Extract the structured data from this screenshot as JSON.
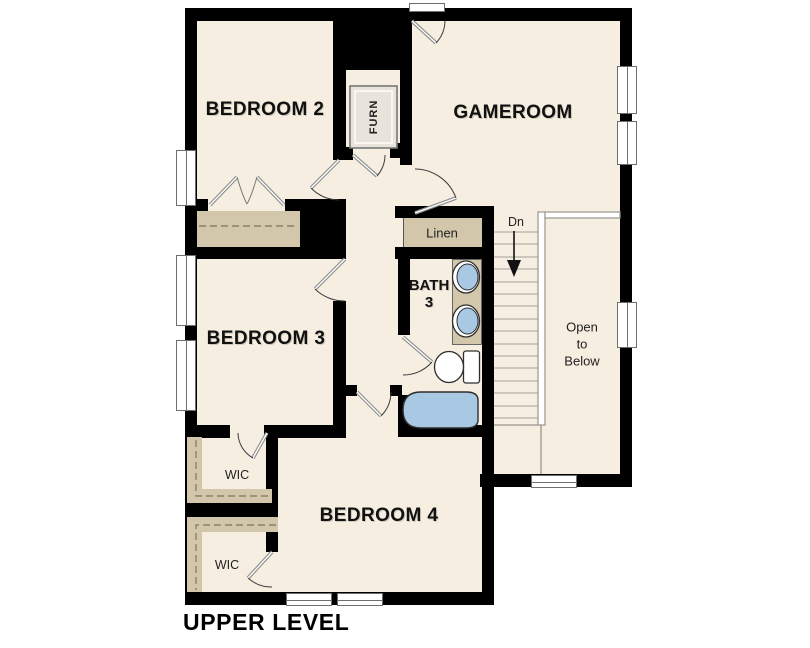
{
  "page": {
    "title": "UPPER LEVEL"
  },
  "colors": {
    "floor": "#f6eee1",
    "wall": "#000000",
    "closet": "#d2c7ab",
    "fixture_blue": "#a9c8e3",
    "stair_line": "#b5b1a8",
    "window_border": "#6e6e6e"
  },
  "rooms": {
    "bedroom2": {
      "label": "BEDROOM 2"
    },
    "gameroom": {
      "label": "GAMEROOM"
    },
    "bedroom3": {
      "label": "BEDROOM 3"
    },
    "bedroom4": {
      "label": "BEDROOM 4"
    },
    "bath3": {
      "line1": "BATH",
      "line2": "3"
    },
    "linen": {
      "label": "Linen"
    },
    "wic_upper": {
      "label": "WIC"
    },
    "wic_lower": {
      "label": "WIC"
    },
    "furnace": {
      "label": "FURN"
    }
  },
  "stairs": {
    "direction_label": "Dn"
  },
  "open_to_below": {
    "line1": "Open",
    "line2": "to",
    "line3": "Below"
  }
}
